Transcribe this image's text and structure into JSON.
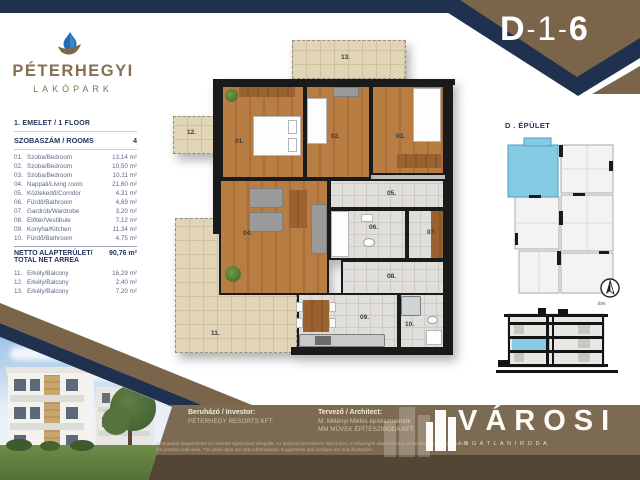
{
  "header": {
    "unit": {
      "building": "D",
      "dash1": "-",
      "floor": "1",
      "dash2": "-",
      "number": "6"
    }
  },
  "logo": {
    "name": "PÉTERHEGYI",
    "sub": "LAKÓPARK"
  },
  "sidebar": {
    "floor_title": "1. EMELET / 1 FLOOR",
    "rooms_header": {
      "label": "SZOBASZÁM / ROOMS",
      "value": "4"
    },
    "rooms": [
      {
        "num": "01.",
        "name": "Szoba/Bedroom",
        "area": "13,14 m²"
      },
      {
        "num": "02.",
        "name": "Szoba/Bedroom",
        "area": "10,50 m²"
      },
      {
        "num": "03.",
        "name": "Szoba/Bedroom",
        "area": "10,11 m²"
      },
      {
        "num": "04.",
        "name": "Nappali/Living room",
        "area": "21,60 m²"
      },
      {
        "num": "05.",
        "name": "Közlekedő/Corridor",
        "area": "4,31 m²"
      },
      {
        "num": "06.",
        "name": "Fürdő/Bathroom",
        "area": "4,69 m²"
      },
      {
        "num": "07.",
        "name": "Gardrób/Wardrobe",
        "area": "3,20 m²"
      },
      {
        "num": "08.",
        "name": "Előtér/Vestibule",
        "area": "7,12 m²"
      },
      {
        "num": "09.",
        "name": "Konyha/Kitchen",
        "area": "11,34 m²"
      },
      {
        "num": "10.",
        "name": "Fürdő/Bathroom",
        "area": "4,75 m²"
      }
    ],
    "net_area": {
      "label_hu": "NETTO ALAPTERÜLET/",
      "label_en": "TOTAL NET ARREA",
      "value": "90,76 m²"
    },
    "balconies": [
      {
        "num": "11.",
        "name": "Erkély/Balcony",
        "area": "16,29 m²"
      },
      {
        "num": "12.",
        "name": "Erkély/Balcony",
        "area": "2,40 m²"
      },
      {
        "num": "13.",
        "name": "Erkély/Balcony",
        "area": "7,20 m²"
      }
    ]
  },
  "plan": {
    "labels": [
      "01.",
      "02.",
      "03.",
      "04.",
      "05.",
      "06.",
      "07.",
      "08.",
      "09.",
      "10.",
      "11.",
      "12.",
      "13."
    ]
  },
  "keyplan": {
    "title": "D . ÉPÜLET",
    "compass_label": "É/N"
  },
  "footer": {
    "investor_label": "Beruházó / Investor:",
    "investor_name": "PÉTERHEGY RESORTS KFT.",
    "architect_label": "Tervező / Architect:",
    "architect_line1": "M. Miltényi Miklós építészmérnök",
    "architect_line2": "MM MŰVEK ÉPÍTÉSZIRODA KFT.",
    "brand_name": "VÁROSI",
    "brand_sub": "I N G A T L A N I R O D A",
    "disclaimer_hu": "A megadott alapterületek és méretek tájékoztató jellegűek. Az ábrázolt berendezés illusztráció. A helyiségek alapterülete a válaszfalak tengelyéig értendő.",
    "disclaimer_en": "the partition wall-axes. The given data are only informational. Equipments and furniture are only illustration."
  },
  "colors": {
    "navy": "#20304f",
    "banner_brown": "#7b654a",
    "footer_brown": "#7d6a52",
    "highlight_blue": "#85cbe4",
    "logo_brown": "#857053"
  }
}
